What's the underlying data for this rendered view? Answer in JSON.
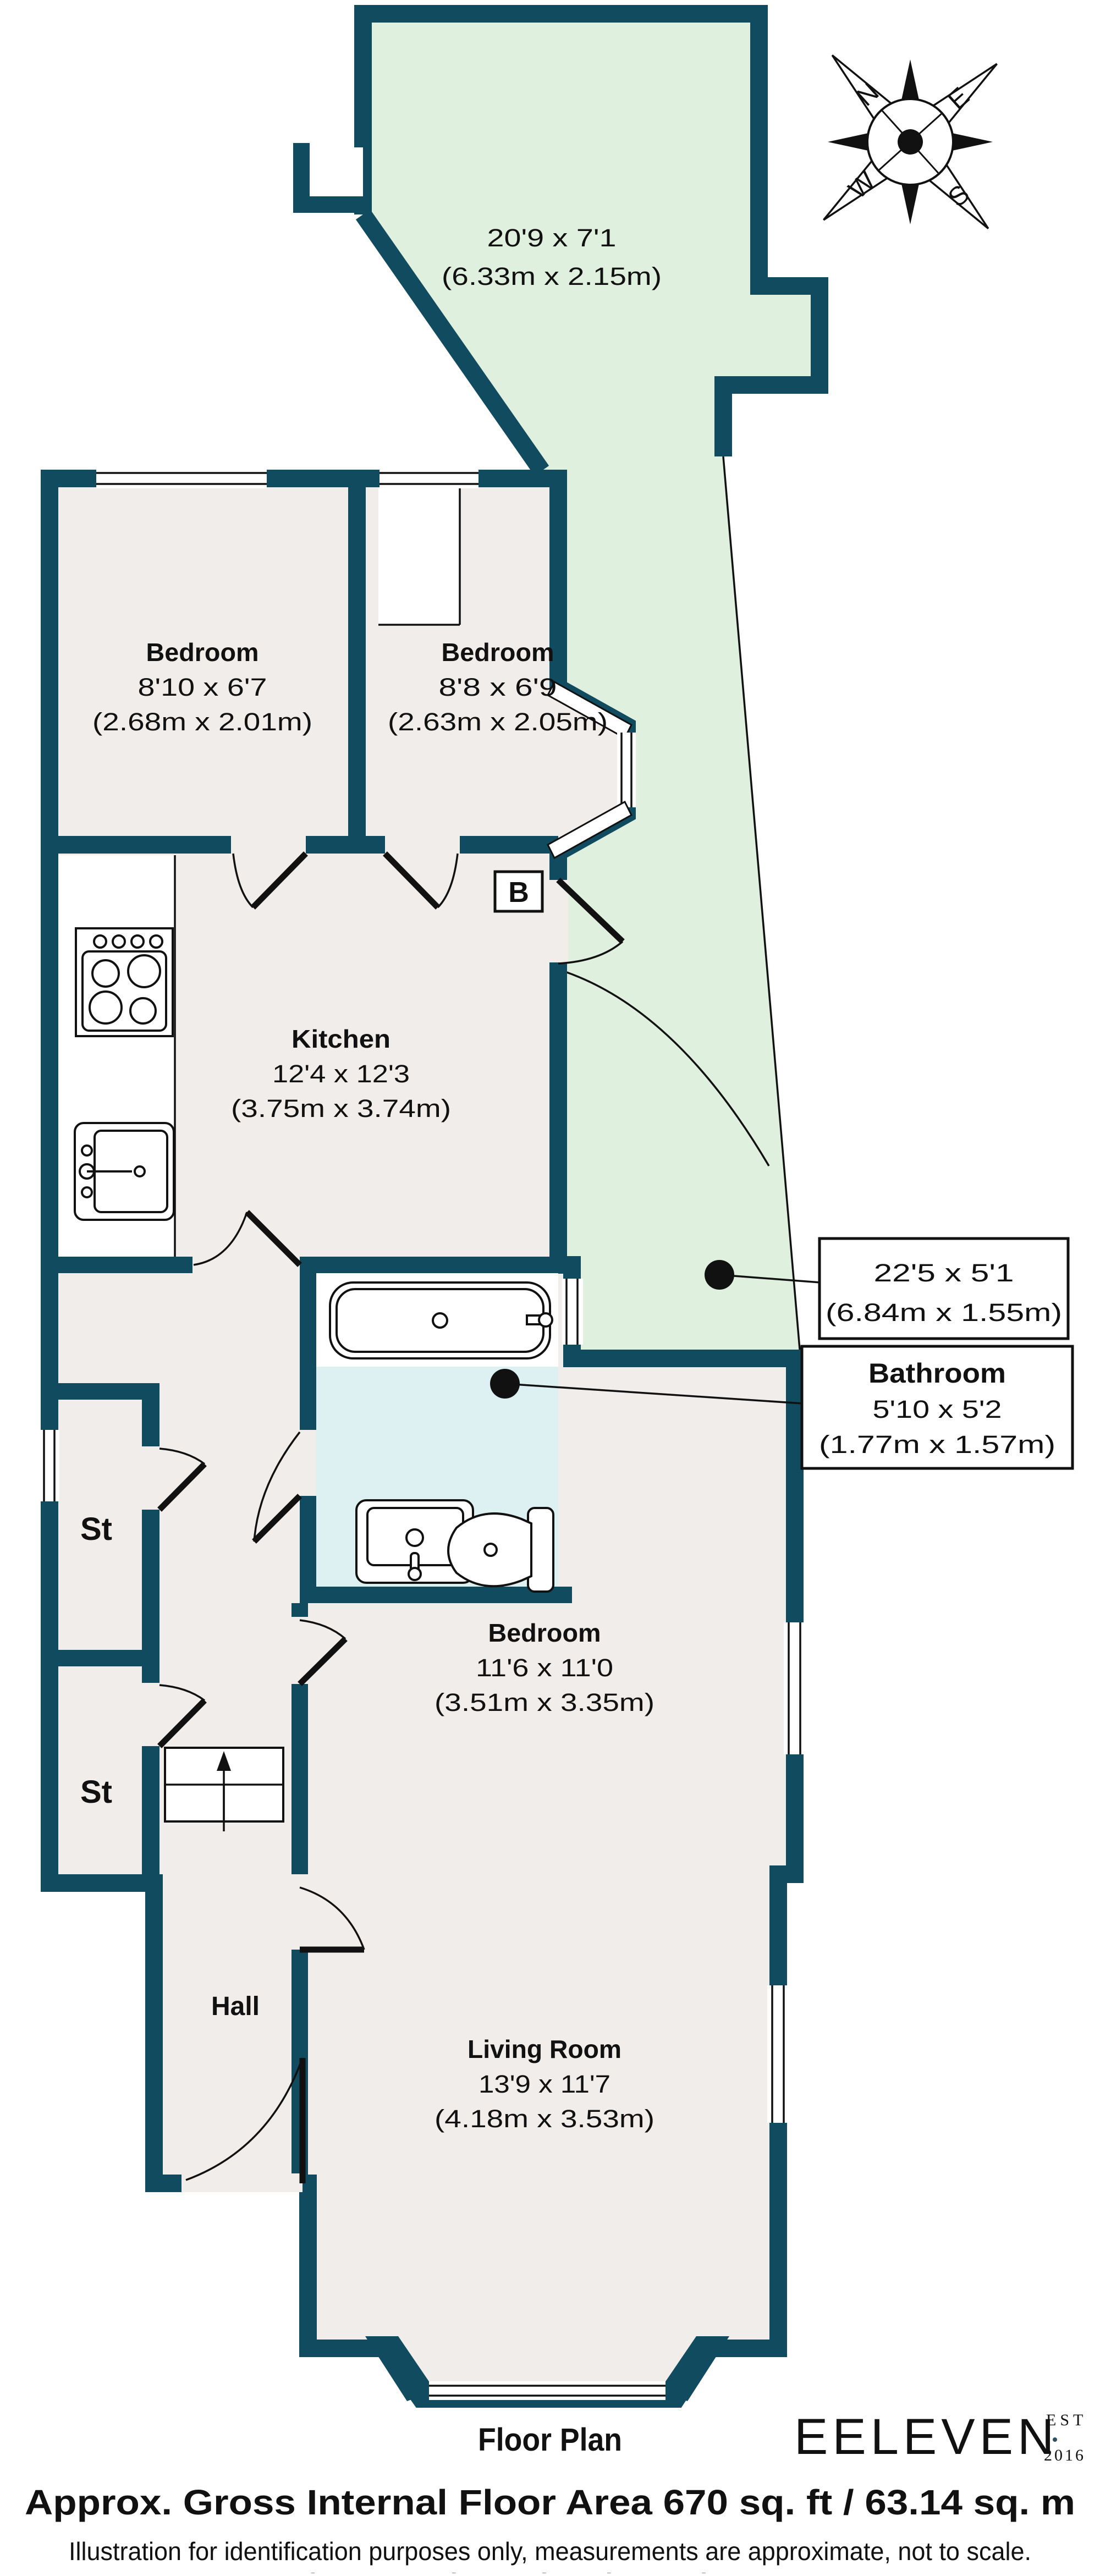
{
  "plan": {
    "side_return": {
      "dims": "20'9 x 7'1",
      "metric": "(6.33m x 2.15m)"
    },
    "bedroom_left": {
      "name": "Bedroom",
      "dims": "8'10 x 6'7",
      "metric": "(2.68m x 2.01m)"
    },
    "bedroom_mid": {
      "name": "Bedroom",
      "dims": "8'8 x 6'9",
      "metric": "(2.63m x 2.05m)"
    },
    "kitchen": {
      "name": "Kitchen",
      "dims": "12'4 x 12'3",
      "metric": "(3.75m x 3.74m)"
    },
    "bedroom_rear": {
      "name": "Bedroom",
      "dims": "11'6 x 11'0",
      "metric": "(3.51m x 3.35m)"
    },
    "living_room": {
      "name": "Living Room",
      "dims": "13'9 x 11'7",
      "metric": "(4.18m x 3.53m)"
    },
    "hall": {
      "name": "Hall"
    },
    "store1": {
      "name": "St"
    },
    "store2": {
      "name": "St"
    },
    "boiler": {
      "label": "B"
    }
  },
  "callouts": {
    "rear_garden": {
      "dims": "22'5 x 5'1",
      "metric": "(6.84m x 1.55m)"
    },
    "bathroom": {
      "name": "Bathroom",
      "dims": "5'10 x 5'2",
      "metric": "(1.77m x 1.57m)"
    }
  },
  "compass": {
    "n": "N",
    "e": "E",
    "s": "S",
    "w": "W"
  },
  "footer": {
    "plan_title": "Floor Plan",
    "area_line": "Approx. Gross Internal Floor Area 670 sq. ft / 63.14 sq. m",
    "disclaimer": "Illustration for identification purposes only, measurements are approximate, not to scale.",
    "credit": "Plan produced using PlanUp."
  },
  "logo": {
    "name": "EELEVEN",
    "est": "EST",
    "year": "2016"
  },
  "colors": {
    "wall": "#114b5f",
    "floor": "#f1edea",
    "outdoor": "#dff0de",
    "bath_floor": "#ddf1f2",
    "logo": "#2e4f63"
  }
}
